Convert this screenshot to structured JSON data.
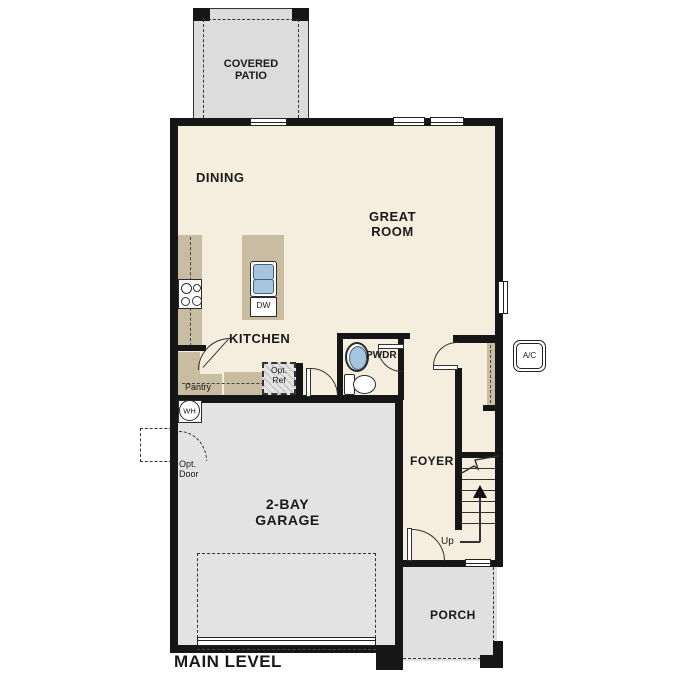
{
  "plan_title": "MAIN LEVEL",
  "rooms": {
    "covered_patio": {
      "line1": "COVERED",
      "line2": "PATIO"
    },
    "dining": {
      "label": "DINING"
    },
    "great_room": {
      "line1": "GREAT",
      "line2": "ROOM"
    },
    "kitchen": {
      "label": "KITCHEN"
    },
    "powder_room": {
      "label": "PWDR"
    },
    "foyer": {
      "label": "FOYER"
    },
    "garage": {
      "line1": "2-BAY",
      "line2": "GARAGE"
    },
    "porch": {
      "label": "PORCH"
    }
  },
  "features": {
    "pantry": {
      "label": "Pantry"
    },
    "optional_refrigerator": {
      "line1": "Opt.",
      "line2": "Ref"
    },
    "optional_door": {
      "line1": "Opt.",
      "line2": "Door"
    },
    "water_heater": {
      "label": "WH"
    },
    "dishwasher": {
      "label": "DW"
    },
    "stairs": {
      "direction_label": "Up"
    },
    "ac_unit": {
      "label": "A/C"
    }
  },
  "colors": {
    "floor": "#f5edde",
    "outdoor_concrete": "#e0e0e0",
    "cabinetry": "#c9bda1",
    "plumbing_blue": "#a5c6de",
    "wall": "#161616"
  }
}
